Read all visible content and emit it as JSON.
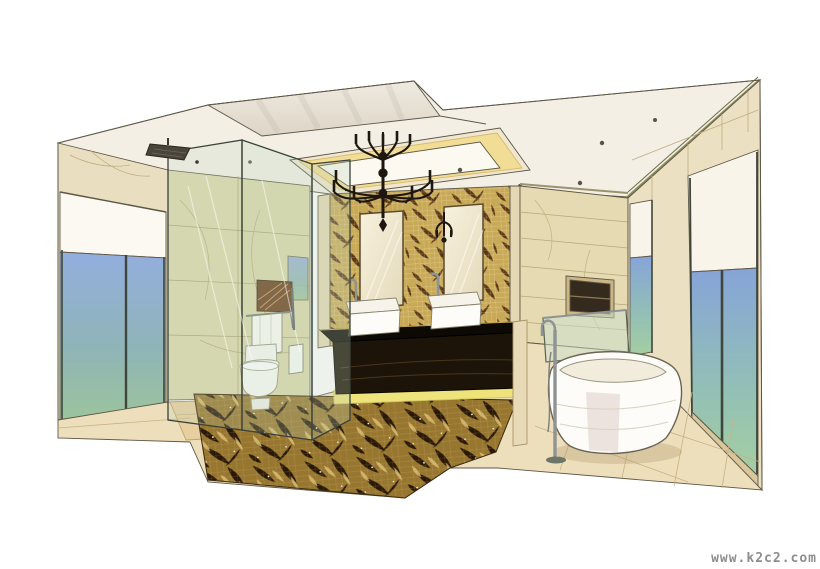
{
  "scene": {
    "type": "hand-drawn marker and colored-pencil interior rendering",
    "subject": "luxury master bathroom in one-point perspective",
    "objects": [
      "stepped white ceiling with recessed tray and warm cove lighting",
      "black wrought-iron candle chandelier",
      "gold and brown leaf-mosaic feature wall",
      "two framed vanity mirrors with black wall sconce",
      "black stone double vanity with two white vessel sinks and chrome faucets",
      "illuminated plinth glow under vanity",
      "leaf-pattern mosaic floor rug",
      "freestanding white oval bathtub",
      "floor-standing chrome tub filler",
      "glass-sided soaking tub",
      "glass shower enclosure with ceiling rain shower head",
      "white toilet with hanging towels",
      "dark recessed wall niches",
      "full-height windows with white roller shades and blue-green glazing",
      "beige marble walls and stone tile floor"
    ]
  },
  "watermark": {
    "text": "www.k2c2.com",
    "color": "#8d8d8d"
  },
  "palette": {
    "paper": "#ffffff",
    "ceiling": "#f3efe5",
    "ceiling_slab": "#e9e3d5",
    "cove_light": "#f2dd96",
    "wall_beige": "#e9dfc0",
    "wall_green_marble": "#dcd8ac",
    "mosaic_gold": "#c8a957",
    "mosaic_brown": "#4e2d0e",
    "rug_gold": "#97762f",
    "rug_dark": "#2a1806",
    "window_blue": "#93aede",
    "window_green": "#9cc49b",
    "vanity_black": "#171209",
    "plinth_glow": "#eee27a",
    "fixture_white": "#fcfbf7",
    "chrome": "#8e9494",
    "sketch_line": "#5f5747"
  }
}
